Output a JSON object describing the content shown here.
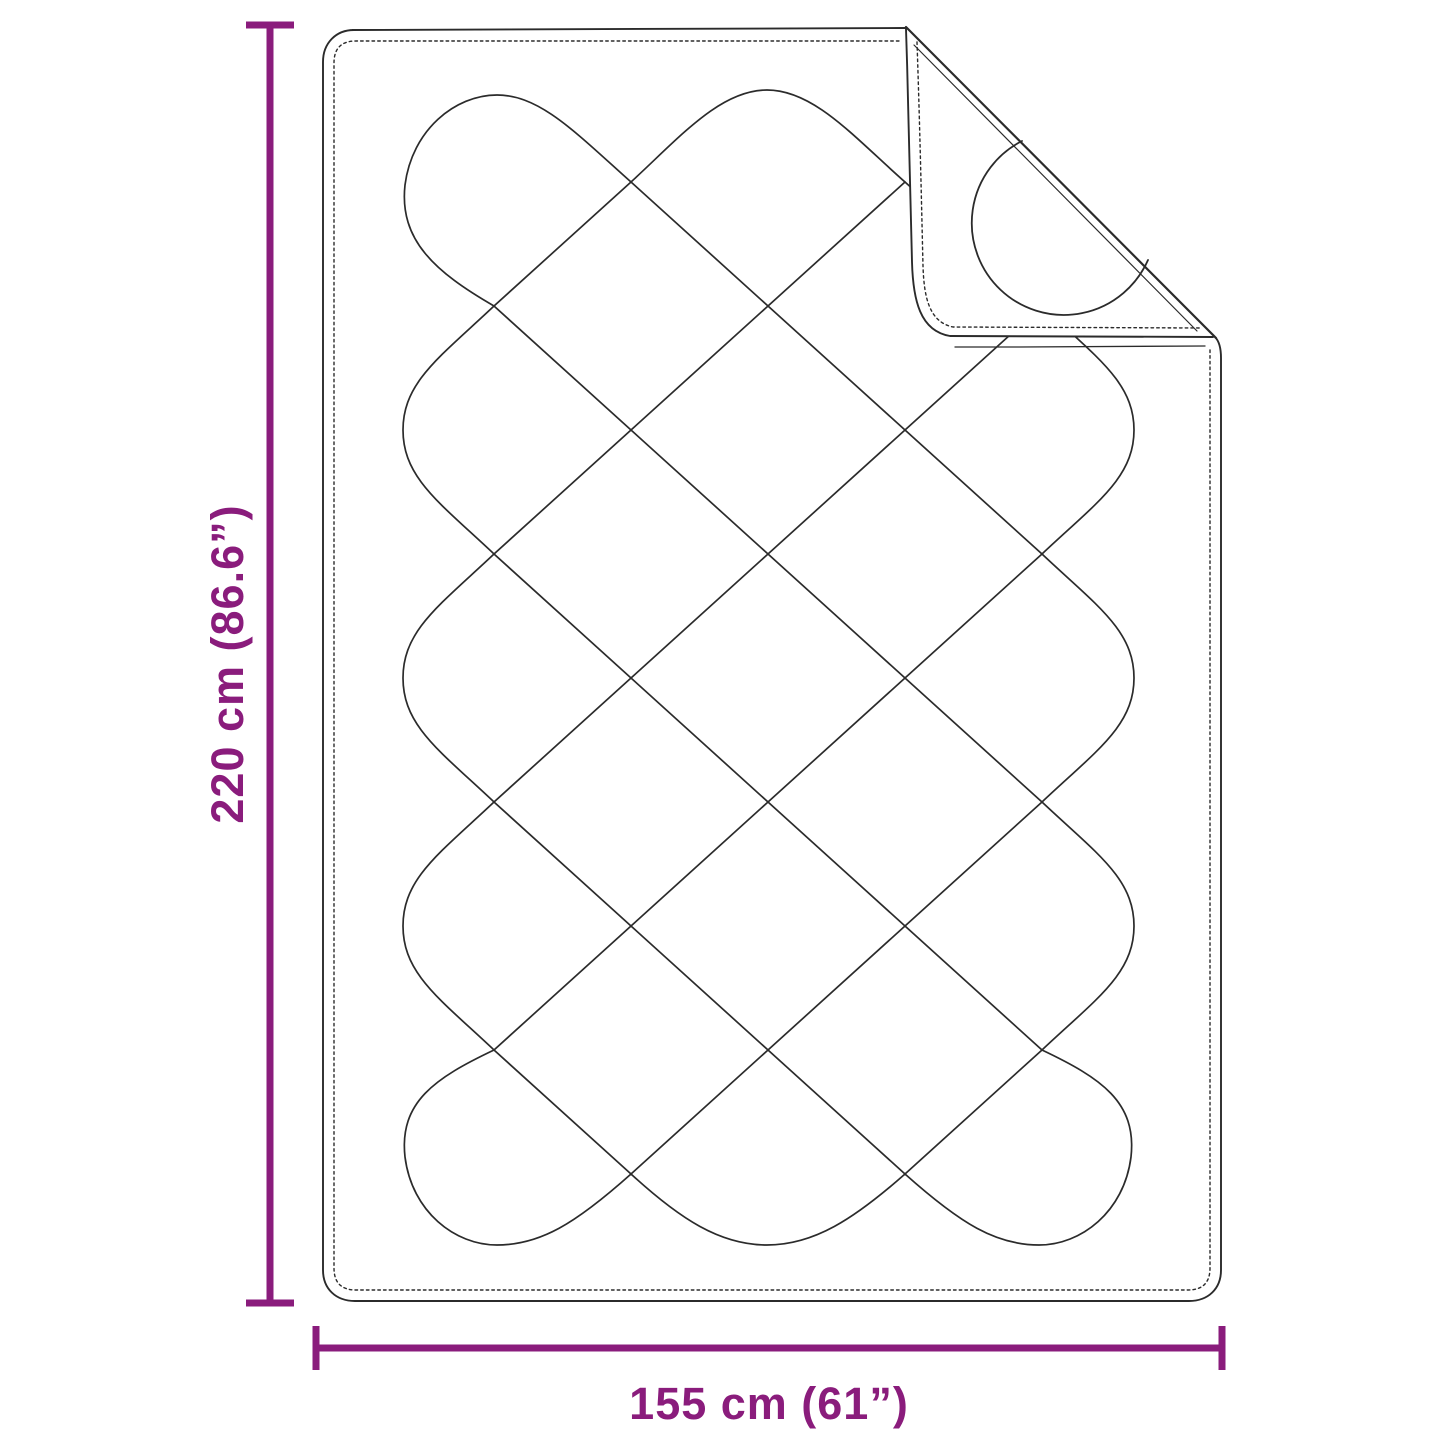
{
  "diagram": {
    "title": "quilted-blanket-dimension-diagram",
    "height_label": "220 cm (86.6”)",
    "width_label": "155 cm (61”)",
    "accent_color": "#8A1C7C",
    "line_color": "#2b2b2b",
    "background_color": "#ffffff"
  }
}
